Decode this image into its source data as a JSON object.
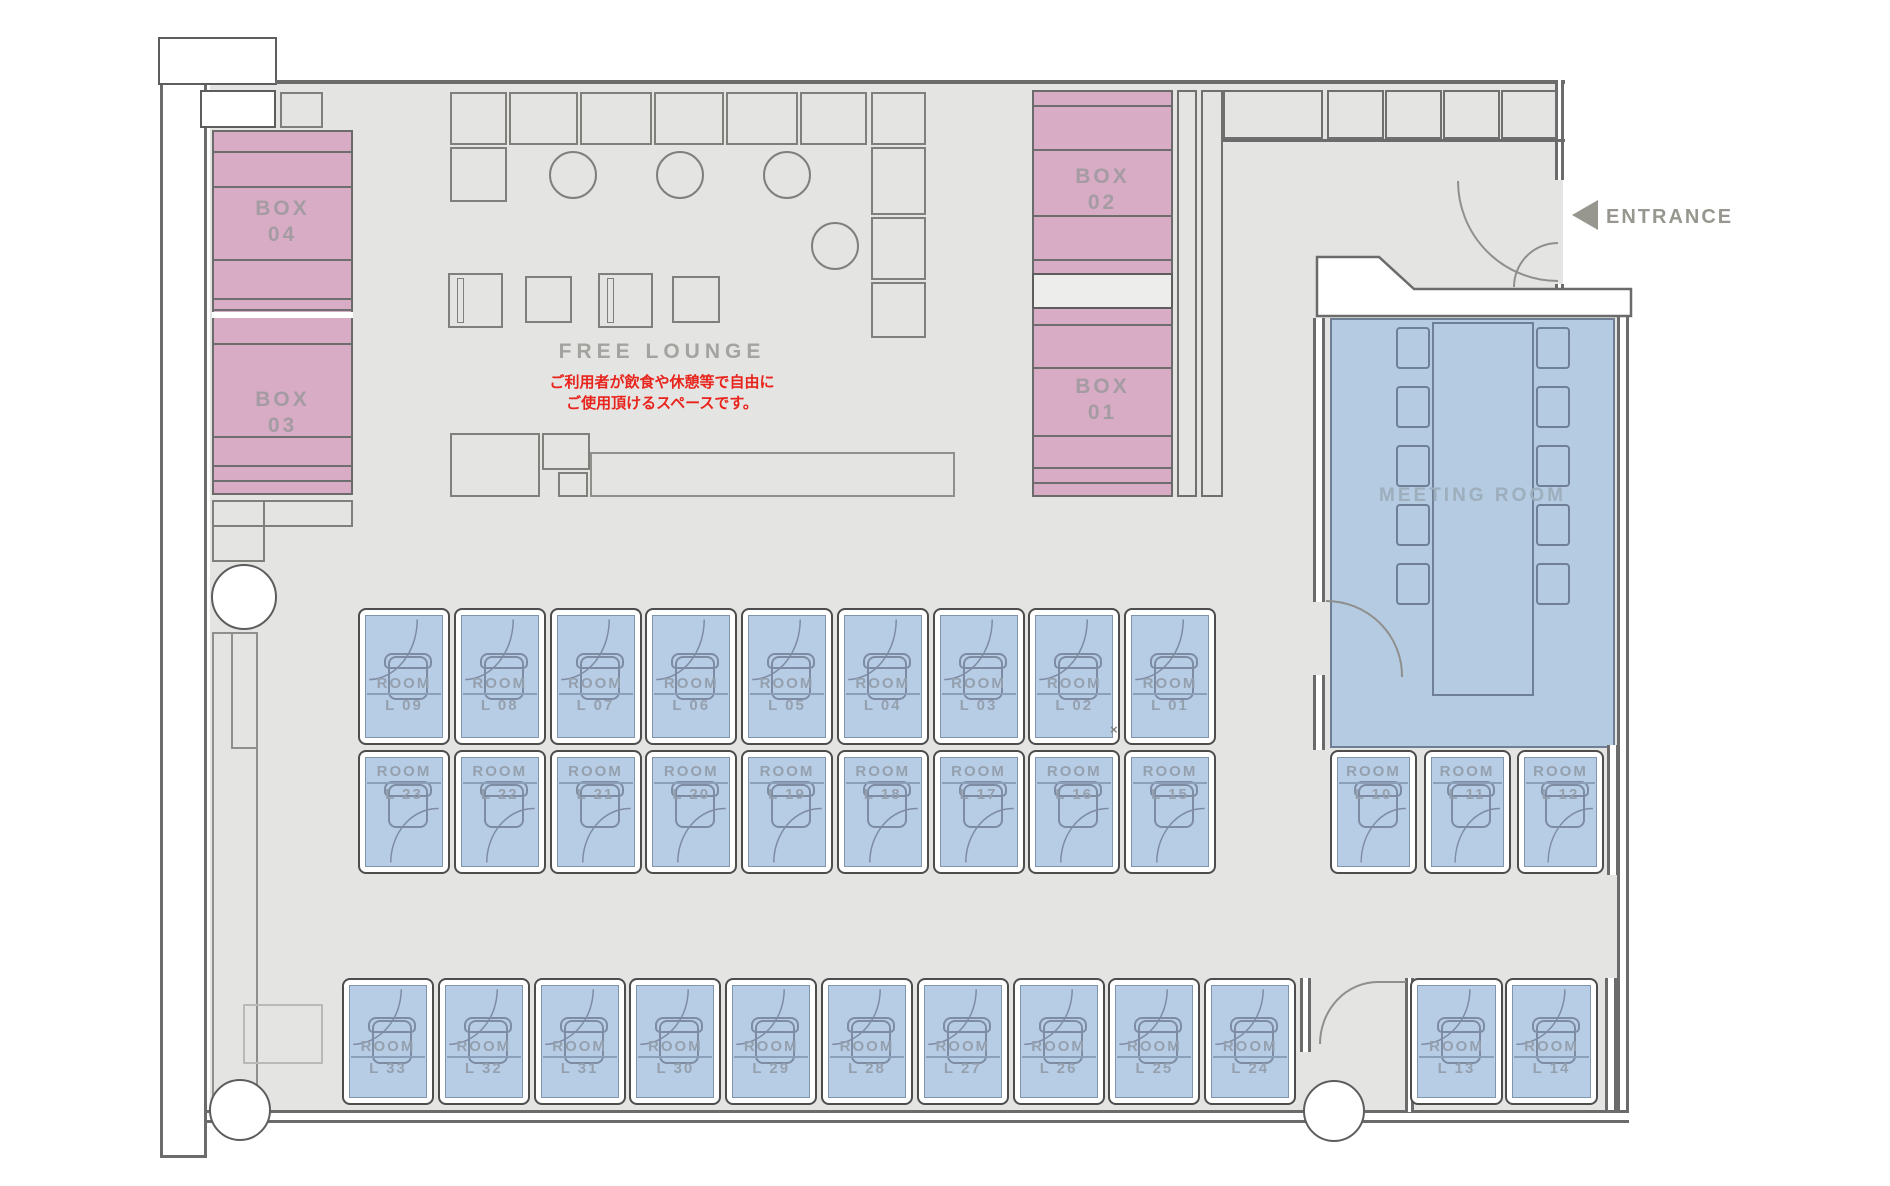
{
  "page": {
    "type": "floor-plan"
  },
  "entrance": {
    "label": "ENTRANCE"
  },
  "free_lounge": {
    "title": "FREE LOUNGE",
    "notice_line1": "ご利用者が飲食や休憩等で自由に",
    "notice_line2": "ご使用頂けるスペースです。"
  },
  "meeting_room": {
    "label": "MEETING ROOM",
    "chairs_per_side": 5
  },
  "boxes": [
    {
      "name": "BOX",
      "number": "04"
    },
    {
      "name": "BOX",
      "number": "03"
    },
    {
      "name": "BOX",
      "number": "02"
    },
    {
      "name": "BOX",
      "number": "01"
    }
  ],
  "rooms": {
    "label": "ROOM",
    "rows": [
      {
        "name": "row-top",
        "ids": [
          "L 09",
          "L 08",
          "L 07",
          "L 06",
          "L 05",
          "L 04",
          "L 03",
          "L 02",
          "L 01"
        ]
      },
      {
        "name": "row-middle",
        "ids": [
          "L 23",
          "L 22",
          "L 21",
          "L 20",
          "L 19",
          "L 18",
          "L 17",
          "L 16",
          "L 15"
        ]
      },
      {
        "name": "row-middle-right",
        "ids": [
          "L 10",
          "L 11",
          "L 12"
        ]
      },
      {
        "name": "row-bottom",
        "ids": [
          "L 33",
          "L 32",
          "L 31",
          "L 30",
          "L 29",
          "L 28",
          "L 27",
          "L 26",
          "L 25",
          "L 24"
        ]
      },
      {
        "name": "row-bottom-right",
        "ids": [
          "L 13",
          "L 14"
        ]
      }
    ]
  },
  "annotations": {
    "cross_mark": "×"
  },
  "colors": {
    "box_pink": "#d8acc4",
    "room_blue": "#b7cde6",
    "meeting_blue": "#b4cbe2",
    "wall_gray": "#6b6b6b",
    "floor_gray": "#e4e4e2",
    "label_gray": "#95a0ae",
    "notice_red": "#e8241c"
  }
}
